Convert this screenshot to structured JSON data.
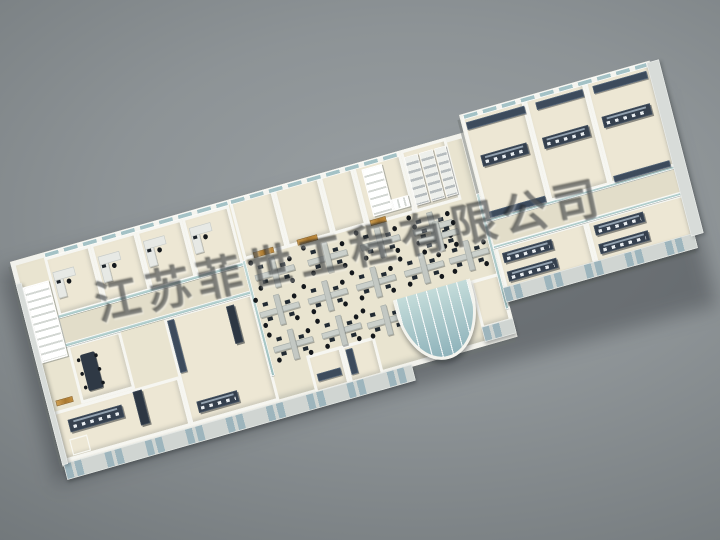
{
  "scene": {
    "type": "3d-architectural-floorplan-render",
    "description": "Bird's-eye 3D render of a long laboratory / office building floor plan model on a gray studio backdrop",
    "backdrop_colors": {
      "center": "#8d9396",
      "edge": "#626669"
    },
    "palette": {
      "wall": "#f2f2ec",
      "floor": "#ede7d4",
      "corridor": "#e2ddc9",
      "glass": "#a4c2c6",
      "lab_bench": "#35404e",
      "wood_door": "#b98a3f",
      "cluster_desk": "#cbd0cb",
      "chair": "#14181c"
    }
  },
  "watermark": {
    "text": "江苏菲世工程有限公司",
    "note": "semi-transparent diagonal watermark stamp"
  },
  "building": {
    "slabs": [
      {
        "x": 0,
        "y": 0,
        "w": 812,
        "h": 330
      },
      {
        "x": 810,
        "y": -28,
        "w": 340,
        "h": 302
      }
    ],
    "rooms": [
      {
        "x": 58,
        "y": 8,
        "w": 82,
        "h": 96
      },
      {
        "x": 140,
        "y": 8,
        "w": 82,
        "h": 96
      },
      {
        "x": 222,
        "y": 8,
        "w": 82,
        "h": 96
      },
      {
        "x": 304,
        "y": 8,
        "w": 84,
        "h": 96
      },
      {
        "x": 58,
        "y": 150,
        "w": 96,
        "h": 94
      },
      {
        "x": 6,
        "y": 244,
        "w": 226,
        "h": 80
      },
      {
        "x": 231,
        "y": 150,
        "w": 158,
        "h": 174
      },
      {
        "x": 390,
        "y": 0,
        "w": 78,
        "h": 98
      },
      {
        "x": 468,
        "y": 0,
        "w": 82,
        "h": 98
      },
      {
        "x": 550,
        "y": 0,
        "w": 60,
        "h": 98
      },
      {
        "x": 610,
        "y": 0,
        "w": 86,
        "h": 100
      },
      {
        "x": 696,
        "y": 0,
        "w": 82,
        "h": 100
      },
      {
        "x": 812,
        "y": -24,
        "w": 112,
        "h": 166
      },
      {
        "x": 924,
        "y": -24,
        "w": 108,
        "h": 166
      },
      {
        "x": 1032,
        "y": -24,
        "w": 118,
        "h": 166
      },
      {
        "x": 812,
        "y": 186,
        "w": 162,
        "h": 76
      },
      {
        "x": 974,
        "y": 186,
        "w": 176,
        "h": 76
      },
      {
        "x": 756,
        "y": 226,
        "w": 54,
        "h": 78
      },
      {
        "x": 452,
        "y": 268,
        "w": 62,
        "h": 62
      },
      {
        "x": 514,
        "y": 268,
        "w": 60,
        "h": 62
      }
    ],
    "open_office": {
      "x": 390,
      "y": 98,
      "w": 420,
      "h": 184
    },
    "corridors": [
      {
        "x": 56,
        "y": 104,
        "w": 334,
        "h": 44
      },
      {
        "x": 810,
        "y": 144,
        "w": 340,
        "h": 40
      }
    ],
    "glass_walls": [
      {
        "x": 56,
        "y": 100,
        "w": 334,
        "h": 6
      },
      {
        "x": 56,
        "y": 146,
        "w": 334,
        "h": 6
      },
      {
        "x": 386,
        "y": 98,
        "w": 6,
        "h": 186
      },
      {
        "x": 804,
        "y": 98,
        "w": 6,
        "h": 186
      },
      {
        "x": 810,
        "y": 140,
        "w": 338,
        "h": 5
      },
      {
        "x": 810,
        "y": 183,
        "w": 338,
        "h": 5
      }
    ],
    "window_strips": [
      {
        "x": 60,
        "y": 1,
        "w": 328,
        "h": 8
      },
      {
        "x": 392,
        "y": 1,
        "w": 300,
        "h": 8
      },
      {
        "x": 816,
        "y": -27,
        "w": 328,
        "h": 8
      }
    ],
    "bottom_walls": [
      {
        "x": 2,
        "y": 326,
        "w": 622,
        "h": 26
      },
      {
        "x": 756,
        "y": 300,
        "w": 56,
        "h": 24
      },
      {
        "x": 808,
        "y": 250,
        "w": 342,
        "h": 24
      }
    ],
    "end_walls": [
      {
        "x": 1144,
        "y": -26,
        "w": 22,
        "h": 280
      },
      {
        "x": 0,
        "y": 36,
        "w": 10,
        "h": 292
      }
    ],
    "stairs": [
      {
        "x": 10,
        "y": 44,
        "w": 46,
        "h": 122,
        "dir": "h"
      },
      {
        "x": 624,
        "y": 12,
        "w": 36,
        "h": 76,
        "dir": "h"
      },
      {
        "x": 660,
        "y": 70,
        "w": 30,
        "h": 18,
        "dir": "v"
      }
    ],
    "shelf_racks": [
      {
        "x": 700,
        "y": 12,
        "w": 24,
        "h": 78
      },
      {
        "x": 727,
        "y": 12,
        "w": 24,
        "h": 78
      },
      {
        "x": 754,
        "y": 12,
        "w": 20,
        "h": 78
      }
    ],
    "wood_doors": [
      {
        "x": 408,
        "y": 90,
        "w": 36,
        "h": 9
      },
      {
        "x": 486,
        "y": 90,
        "w": 36,
        "h": 9
      },
      {
        "x": 616,
        "y": 92,
        "w": 28,
        "h": 9
      },
      {
        "x": 16,
        "y": 228,
        "w": 30,
        "h": 9
      }
    ],
    "lab_benches": [
      {
        "x": 28,
        "y": 262,
        "w": 96,
        "h": 20
      },
      {
        "x": 250,
        "y": 290,
        "w": 72,
        "h": 18
      },
      {
        "x": 828,
        "y": 42,
        "w": 82,
        "h": 18
      },
      {
        "x": 938,
        "y": 42,
        "w": 82,
        "h": 18
      },
      {
        "x": 1046,
        "y": 36,
        "w": 86,
        "h": 18
      },
      {
        "x": 822,
        "y": 198,
        "w": 88,
        "h": 16
      },
      {
        "x": 822,
        "y": 228,
        "w": 88,
        "h": 16
      },
      {
        "x": 986,
        "y": 196,
        "w": 88,
        "h": 16
      },
      {
        "x": 986,
        "y": 226,
        "w": 88,
        "h": 16
      }
    ],
    "wall_counters": [
      {
        "x": 818,
        "y": -14,
        "w": 104,
        "h": 12
      },
      {
        "x": 942,
        "y": -14,
        "w": 84,
        "h": 12
      },
      {
        "x": 1044,
        "y": -14,
        "w": 96,
        "h": 12
      },
      {
        "x": 818,
        "y": 130,
        "w": 100,
        "h": 10
      },
      {
        "x": 1040,
        "y": 130,
        "w": 100,
        "h": 10
      },
      {
        "x": 236,
        "y": 156,
        "w": 12,
        "h": 84
      },
      {
        "x": 462,
        "y": 300,
        "w": 42,
        "h": 12
      },
      {
        "x": 520,
        "y": 276,
        "w": 12,
        "h": 40
      }
    ],
    "cabinets": [
      {
        "x": 148,
        "y": 248,
        "w": 16,
        "h": 54
      },
      {
        "x": 340,
        "y": 160,
        "w": 14,
        "h": 60
      }
    ],
    "meeting_table": {
      "x": 76,
      "y": 170,
      "w": 26,
      "h": 58
    },
    "floor_marks": [
      {
        "x": 22,
        "y": 292,
        "w": 32,
        "h": 26
      }
    ],
    "workstation_clusters": [
      {
        "x": 400,
        "y": 104
      },
      {
        "x": 494,
        "y": 104
      },
      {
        "x": 588,
        "y": 104
      },
      {
        "x": 682,
        "y": 104
      },
      {
        "x": 392,
        "y": 162
      },
      {
        "x": 478,
        "y": 162
      },
      {
        "x": 564,
        "y": 162
      },
      {
        "x": 650,
        "y": 162
      },
      {
        "x": 730,
        "y": 162
      },
      {
        "x": 400,
        "y": 220
      },
      {
        "x": 486,
        "y": 220
      },
      {
        "x": 566,
        "y": 224
      },
      {
        "x": 688,
        "y": 120
      }
    ],
    "office_desks": [
      {
        "x": 66,
        "y": 34
      },
      {
        "x": 148,
        "y": 30
      },
      {
        "x": 230,
        "y": 26
      },
      {
        "x": 312,
        "y": 26
      }
    ],
    "bay_window": {
      "x": 620,
      "y": 222,
      "w": 138,
      "h": 112
    }
  }
}
